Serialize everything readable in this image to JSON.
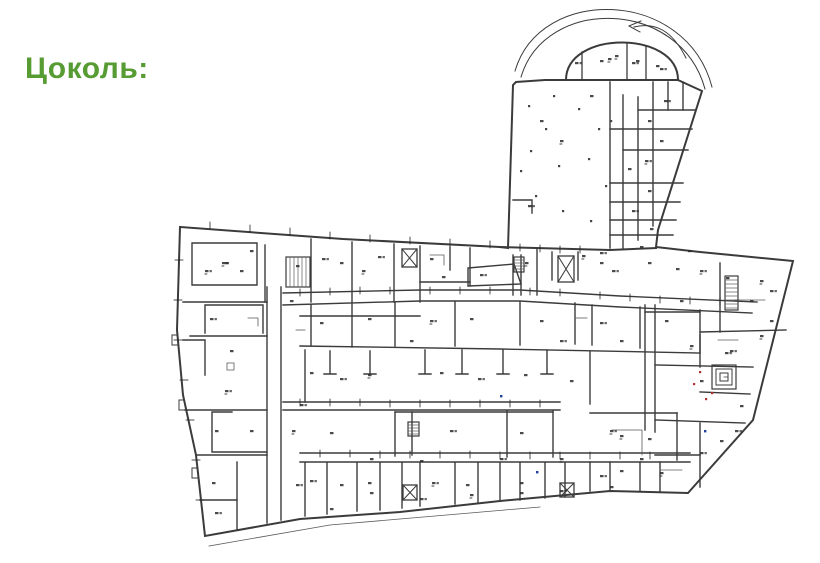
{
  "page": {
    "background_color": "#ffffff"
  },
  "title": {
    "text": "Цоколь:",
    "color": "#579b33"
  },
  "plan": {
    "name": "basement-floor-plan",
    "line_color": "#3b3b3b",
    "thin_line_color": "#5a5a5a",
    "label_mark_color": "#2a2a2a",
    "red_annotation_color": "#b03030",
    "blue_annotation_color": "#2040a0",
    "symbols": {
      "ramp_arrow_icon": "curved-left-arrow",
      "elevator_icon": "crossed-box",
      "staircase_icon": "rung-hatched-box",
      "spiral_staircase_icon": "nested-squares",
      "column_icon": "small-dot"
    }
  }
}
